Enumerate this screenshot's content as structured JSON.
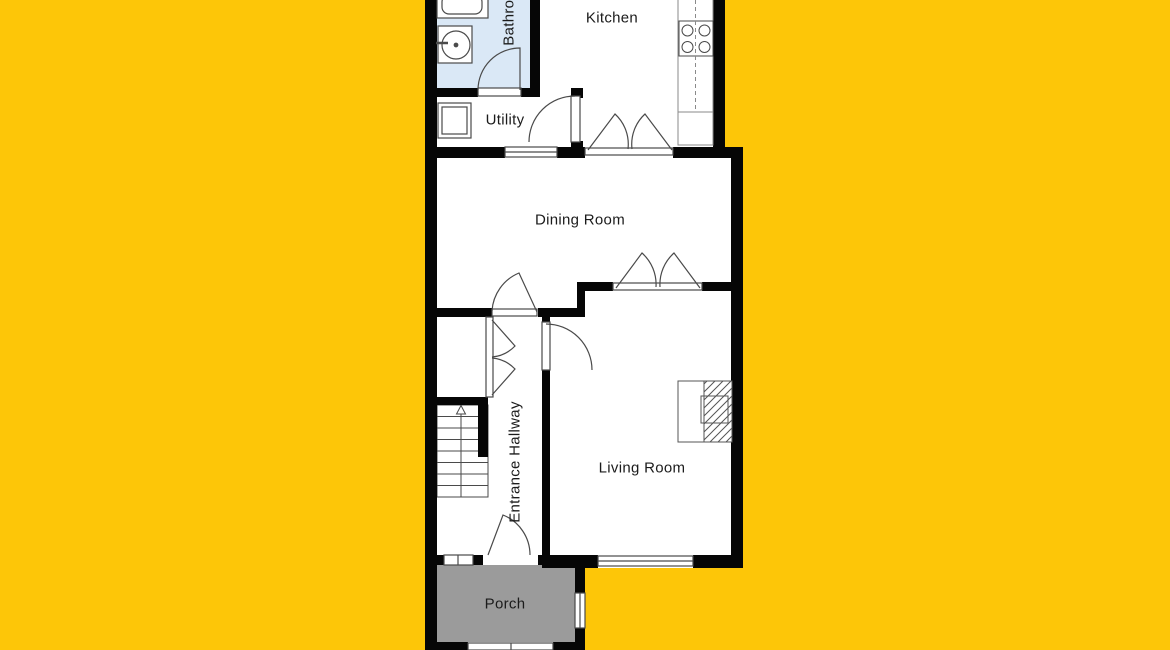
{
  "colors": {
    "background": "#FDC608",
    "wall": "#060606",
    "line": "#4a4a4a",
    "counter_line": "#8a8a8a",
    "room_fill": "#ffffff",
    "bathroom_fill": "#dae8f6",
    "porch_fill": "#9b9b9b",
    "text": "#1b1b1b"
  },
  "rooms": {
    "bathroom": "Bathroom",
    "kitchen": "Kitchen",
    "utility": "Utility",
    "dining_room": "Dining Room",
    "entrance_hallway": "Entrance Hallway",
    "living_room": "Living Room",
    "porch": "Porch"
  }
}
